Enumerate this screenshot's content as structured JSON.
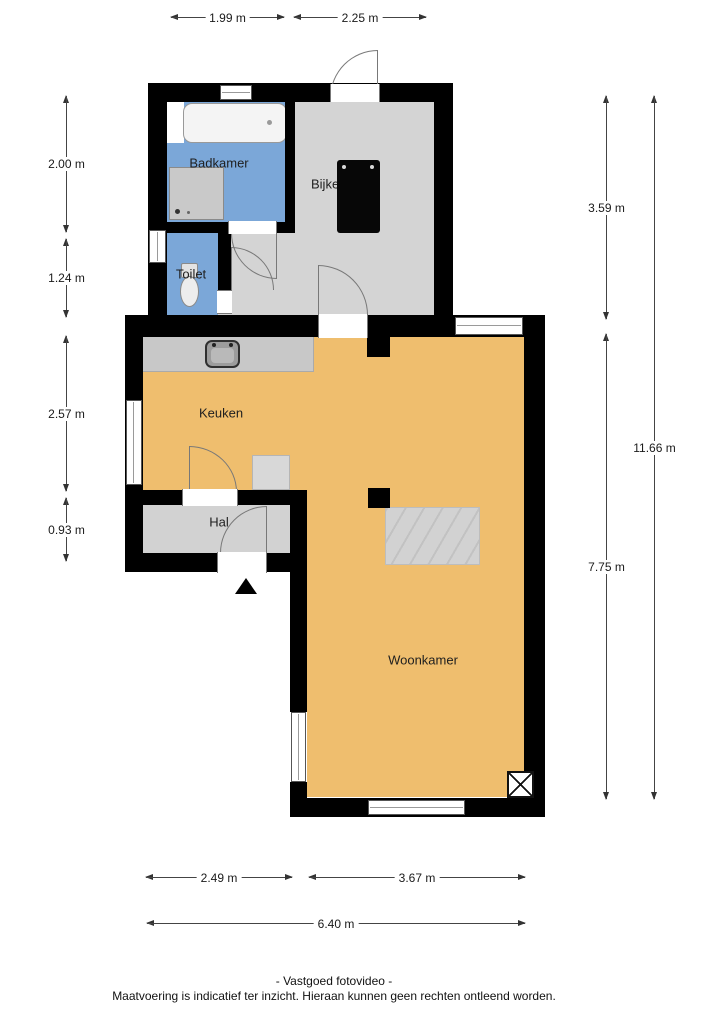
{
  "rooms": {
    "badkamer": "Badkamer",
    "bijkeuken": "Bijkeuken",
    "toilet": "Toilet",
    "keuken": "Keuken",
    "hal": "Hal",
    "woonkamer": "Woonkamer"
  },
  "dimensions": {
    "top": [
      "1.99 m",
      "2.25 m"
    ],
    "left": [
      "2.00 m",
      "1.24 m",
      "2.57 m",
      "0.93 m"
    ],
    "right": [
      "3.59 m",
      "7.75 m",
      "11.66 m"
    ],
    "bottom": [
      "2.49 m",
      "3.67 m",
      "6.40 m"
    ]
  },
  "footer": {
    "line1": "- Vastgoed fotovideo -",
    "line2": "Maatvoering is indicatief ter inzicht. Hieraan kunnen geen rechten ontleend worden."
  },
  "colors": {
    "wall": "#000000",
    "floor-living": "#EFBE6E",
    "floor-wet": "#7BA7D8",
    "floor-utility": "#D4D4D4",
    "floor-hall": "#D2D2D2",
    "counter": "#C8C8C8"
  }
}
